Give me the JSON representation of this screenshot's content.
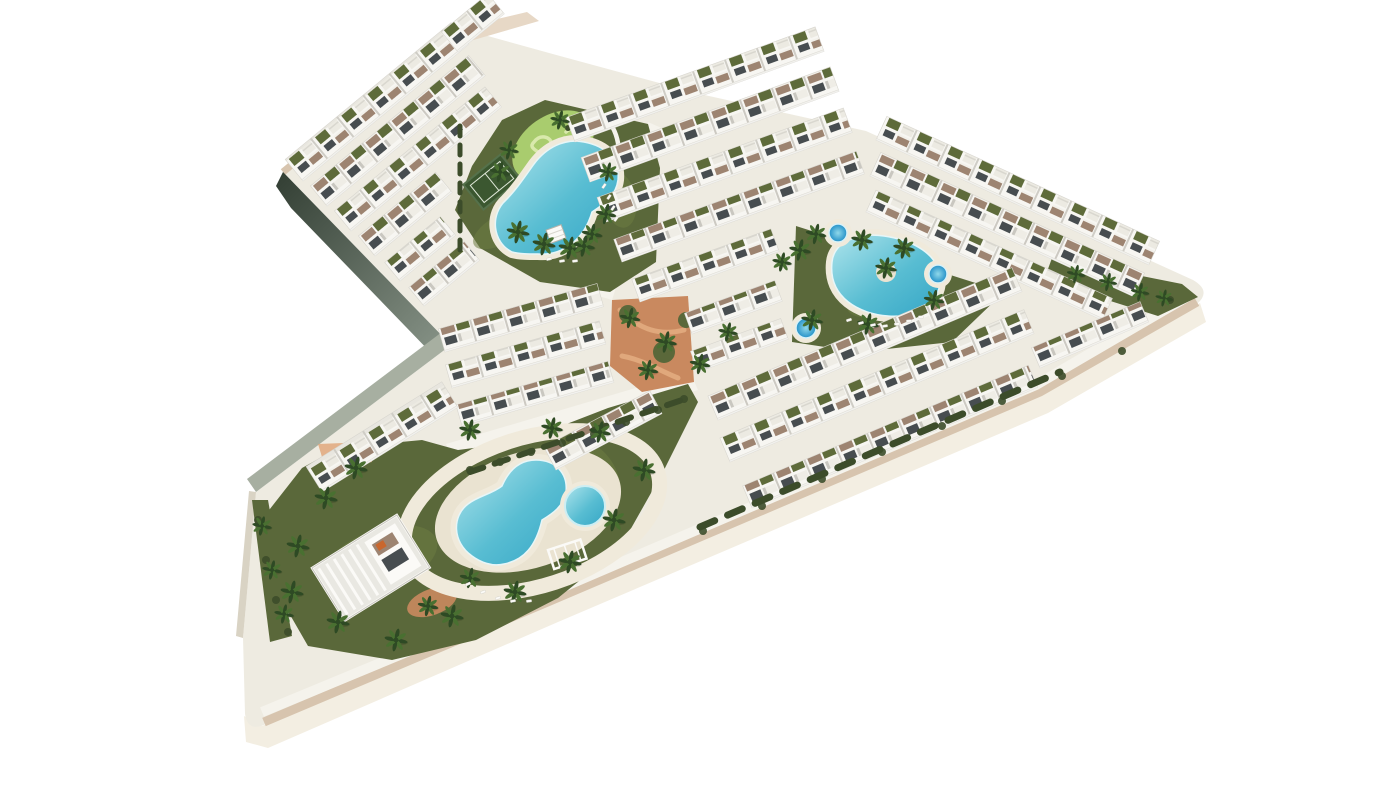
{
  "meta": {
    "title": "Aerial 3D render of a residential resort complex with white apartment blocks, gardens and three swimming pools",
    "canvas_w": 1400,
    "canvas_h": 788
  },
  "palette": {
    "bg": "#ffffff",
    "base": "#eeebe1",
    "road": "#f5f3ec",
    "tan": "#d7c4ae",
    "tanLight": "#e7d8c6",
    "cream": "#f3eee2",
    "deck": "#eae3d1",
    "deckLight": "#f0eadb",
    "darkFaceA": "#323e33",
    "darkFaceB": "#8a968a",
    "grayFace": "#a7afa1",
    "westFace": "#d9d3c4",
    "lawn": "#5a683a",
    "lawnLight": "#6d7c42",
    "hedge": "#3c4c2a",
    "poolLight": "#aee4ec",
    "poolMid": "#58bdd2",
    "poolDeep": "#35a6c6",
    "spaLight": "#8fd8ea",
    "spaDeep": "#2491c8",
    "minigolf": "#a9cc6e",
    "minigolfPath": "#d9e9ac",
    "court": "#3b5730",
    "courtLine": "#dfe8d8",
    "terracotta": "#c9895f",
    "terracottaLight": "#e0a87c",
    "bldg": "#f7f6f2",
    "window": "#474d50",
    "terrace": "#9d8471",
    "roofOlive": "#5e6b3a",
    "palmDark": "#2e4a24",
    "palmMid": "#497031",
    "trunk": "#8d7d5f",
    "white": "#fbfaf7"
  },
  "scene": {
    "outline_path": "M 283,172 L 459,28 L 560,56 L 700,94 L 866,131 L 1193,280 Q 1212,291 1197,304 L 1040,392 L 550,601 L 268,723 Q 248,734 245,714 L 243,638 L 256,492 L 451,345 Z",
    "face_bottom": [
      [
        1200,
        303
      ],
      [
        1040,
        392
      ],
      [
        550,
        601
      ],
      [
        262,
        726
      ],
      [
        244,
        716
      ],
      [
        246,
        742
      ],
      [
        268,
        748
      ],
      [
        558,
        622
      ],
      [
        1048,
        413
      ],
      [
        1206,
        322
      ]
    ],
    "edge_tan_path": "M 1197,302 L 1040,392 L 550,601 L 264,722",
    "edge_walk_path": "M 1192,294 L 1036,385 L 547,594 L 262,712",
    "nw_tan_path": "M 283,172 L 459,28",
    "nw_tan_sliver": [
      [
        459,
        28
      ],
      [
        527,
        12
      ],
      [
        539,
        21
      ],
      [
        470,
        41
      ]
    ],
    "dark_face": [
      [
        283,
        172
      ],
      [
        451,
        345
      ],
      [
        434,
        356
      ],
      [
        291,
        208
      ],
      [
        276,
        186
      ]
    ],
    "gray_face": [
      [
        451,
        345
      ],
      [
        256,
        492
      ],
      [
        247,
        479
      ],
      [
        442,
        332
      ]
    ],
    "west_face": [
      [
        256,
        492
      ],
      [
        243,
        638
      ],
      [
        236,
        636
      ],
      [
        249,
        491
      ]
    ],
    "roads": [
      [
        [
          446,
          444
        ],
        [
          690,
          372
        ],
        [
          698,
          390
        ],
        [
          456,
          464
        ]
      ],
      [
        [
          592,
          294
        ],
        [
          648,
          122
        ],
        [
          666,
          130
        ],
        [
          612,
          300
        ]
      ]
    ],
    "gardens": {
      "main": [
        [
          455,
          210
        ],
        [
          472,
          166
        ],
        [
          502,
          120
        ],
        [
          545,
          100
        ],
        [
          648,
          124
        ],
        [
          660,
          168
        ],
        [
          656,
          262
        ],
        [
          610,
          292
        ],
        [
          540,
          282
        ],
        [
          480,
          248
        ]
      ],
      "oval": [
        [
          796,
          226
        ],
        [
          1004,
          292
        ],
        [
          952,
          342
        ],
        [
          858,
          352
        ],
        [
          792,
          342
        ]
      ],
      "lower": [
        [
          302,
          468
        ],
        [
          338,
          448
        ],
        [
          422,
          440
        ],
        [
          458,
          450
        ],
        [
          520,
          442
        ],
        [
          608,
          408
        ],
        [
          688,
          384
        ],
        [
          698,
          402
        ],
        [
          664,
          470
        ],
        [
          620,
          548
        ],
        [
          558,
          598
        ],
        [
          476,
          640
        ],
        [
          392,
          660
        ],
        [
          308,
          646
        ],
        [
          270,
          580
        ],
        [
          266,
          514
        ]
      ],
      "tip": [
        [
          1052,
          258
        ],
        [
          1182,
          284
        ],
        [
          1198,
          297
        ],
        [
          1158,
          316
        ],
        [
          1044,
          280
        ]
      ],
      "west": [
        [
          252,
          500
        ],
        [
          268,
          500
        ],
        [
          292,
          636
        ],
        [
          270,
          642
        ]
      ]
    },
    "lawn_patches": [
      [
        500,
        230,
        30,
        14,
        -30
      ],
      [
        620,
        200,
        16,
        28,
        -10
      ],
      [
        380,
        560,
        60,
        30,
        -20
      ],
      [
        590,
        480,
        28,
        40,
        -25
      ],
      [
        880,
        300,
        34,
        16,
        -15
      ]
    ],
    "courtyard": [
      [
        612,
        300
      ],
      [
        688,
        296
      ],
      [
        694,
        382
      ],
      [
        642,
        392
      ],
      [
        610,
        366
      ]
    ],
    "courtyard_greens": [
      [
        628,
        314,
        9
      ],
      [
        664,
        352,
        11
      ],
      [
        686,
        320,
        8
      ]
    ],
    "courtyard_paths": [
      "M 620,310 C 640,330 660,336 684,330",
      "M 622,356 C 644,360 662,372 678,378"
    ],
    "terracotta_small": [
      [
        318,
        444
      ],
      [
        368,
        442
      ],
      [
        372,
        462
      ],
      [
        326,
        470
      ]
    ],
    "terracotta_blob": {
      "cx": 432,
      "cy": 602,
      "rx": 26,
      "ry": 13,
      "rot": -20
    },
    "ring": {
      "cx": 532,
      "cy": 512,
      "rx": 132,
      "ry": 74,
      "rot": -18
    },
    "deck_blob": {
      "cx": 528,
      "cy": 510,
      "rx": 96,
      "ry": 58,
      "rot": -18
    },
    "pools": {
      "main": "M 512,252 C 492,242 490,214 506,200 C 516,190 524,178 534,164 C 546,148 564,138 584,142 C 606,146 620,160 618,180 C 616,196 604,204 592,212 C 584,240 562,256 538,254 C 528,254 520,254 512,252 Z",
      "oval": "M 832,262 C 834,242 858,232 884,236 C 912,240 940,254 940,280 C 940,304 916,318 888,316 C 860,314 828,298 832,262 Z",
      "lower": "M 472,556 C 452,542 452,516 468,504 C 478,496 492,494 502,486 C 508,472 518,460 536,460 C 556,460 568,474 566,492 C 564,506 552,514 542,520 C 536,546 524,560 504,564 C 492,567 480,562 472,556 Z",
      "kid": {
        "cx": 585,
        "cy": 506,
        "r": 20
      },
      "island": {
        "cx": 886,
        "cy": 272,
        "r": 10
      }
    },
    "spas": [
      [
        838,
        233,
        9
      ],
      [
        938,
        274,
        9
      ],
      [
        806,
        328,
        10
      ]
    ],
    "minigolf": {
      "cx": 553,
      "cy": 146,
      "rx": 45,
      "ry": 30,
      "rot": -35,
      "paths": [
        "M 534,142 c 6,-8 16,-6 18,2 c 2,8 -8,12 -14,8 c -6,-4 -8,-6 -4,-10",
        "M 556,158 c 8,-4 14,2 10,8 c -4,6 -14,4 -14,-2",
        "M 566,132 c 6,-6 14,-2 12,6 c -2,8 -12,6 -14,0"
      ],
      "wall": "M 596,110 C 620,124 626,158 610,188",
      "bushes": [
        [
          568,
          128,
          3
        ],
        [
          538,
          160,
          2.5
        ],
        [
          580,
          150,
          2.2
        ]
      ]
    },
    "court": {
      "cx": 492,
      "cy": 182,
      "w": 48,
      "h": 32,
      "rot": -39
    },
    "rows": [
      [
        303,
        181,
        215,
        28,
        -39.5,
        "A"
      ],
      [
        327,
        206,
        205,
        26,
        -39.5,
        "B"
      ],
      [
        351,
        231,
        195,
        26,
        -39.5,
        "A"
      ],
      [
        375,
        256,
        100,
        26,
        -39.5,
        "B"
      ],
      [
        400,
        281,
        72,
        24,
        -39.5,
        "A"
      ],
      [
        424,
        306,
        72,
        24,
        -39.5,
        "B"
      ],
      [
        458,
        52,
        60,
        26,
        -39.5,
        "A"
      ],
      [
        575,
        142,
        265,
        26,
        -20,
        "A"
      ],
      [
        590,
        182,
        265,
        26,
        -20,
        "B"
      ],
      [
        606,
        222,
        262,
        26,
        -20,
        "A"
      ],
      [
        622,
        262,
        258,
        24,
        -20,
        "B"
      ],
      [
        640,
        302,
        148,
        24,
        -20,
        "A"
      ],
      [
        692,
        334,
        96,
        22,
        -20,
        "B"
      ],
      [
        698,
        372,
        96,
        22,
        -20,
        "A"
      ],
      [
        876,
        140,
        300,
        26,
        24.6,
        "A"
      ],
      [
        870,
        176,
        290,
        26,
        24.6,
        "B"
      ],
      [
        866,
        212,
        260,
        24,
        24.6,
        "A"
      ],
      [
        445,
        352,
        165,
        24,
        -16,
        "B"
      ],
      [
        452,
        388,
        160,
        24,
        -16,
        "A"
      ],
      [
        462,
        426,
        158,
        22,
        -16,
        "B"
      ],
      [
        718,
        420,
        330,
        26,
        -22.9,
        "B"
      ],
      [
        730,
        462,
        330,
        26,
        -22.9,
        "A"
      ],
      [
        752,
        508,
        310,
        24,
        -22.9,
        "B"
      ],
      [
        1040,
        368,
        118,
        22,
        -23,
        "B"
      ],
      [
        322,
        492,
        160,
        30,
        -32,
        "A"
      ],
      [
        556,
        470,
        120,
        26,
        -28,
        "B"
      ]
    ],
    "villa": {
      "x": 312,
      "y": 568,
      "w": 100,
      "h": 62,
      "rot": -32
    },
    "gazebo": {
      "x": 556,
      "y": 234,
      "rot": -20
    },
    "pergola": {
      "x": 548,
      "y": 550,
      "w": 34,
      "h": 20,
      "rot": -18
    },
    "hedge_lines": [
      {
        "d": "M 700,527 L 1060,372",
        "w": 7,
        "dash": "16 14"
      },
      {
        "d": "M 470,472 L 688,398",
        "w": 6,
        "dash": "14 12"
      },
      {
        "d": "M 460,250 L 460,120",
        "w": 5,
        "dash": "10 9"
      }
    ],
    "palms": [
      [
        518,
        232,
        1
      ],
      [
        544,
        244,
        1
      ],
      [
        570,
        248,
        1
      ],
      [
        592,
        234,
        0.9
      ],
      [
        606,
        214,
        0.9
      ],
      [
        500,
        172,
        0.9
      ],
      [
        509,
        150,
        0.85
      ],
      [
        608,
        172,
        0.85
      ],
      [
        560,
        120,
        0.85
      ],
      [
        584,
        246,
        0.95
      ],
      [
        800,
        250,
        0.95
      ],
      [
        816,
        234,
        0.9
      ],
      [
        862,
        240,
        0.95
      ],
      [
        904,
        248,
        0.95
      ],
      [
        934,
        300,
        0.9
      ],
      [
        868,
        324,
        0.95
      ],
      [
        812,
        320,
        0.95
      ],
      [
        782,
        262,
        0.85
      ],
      [
        886,
        268,
        0.95
      ],
      [
        630,
        318,
        0.9
      ],
      [
        666,
        342,
        0.95
      ],
      [
        700,
        364,
        0.9
      ],
      [
        728,
        332,
        0.85
      ],
      [
        648,
        370,
        0.9
      ],
      [
        356,
        468,
        1
      ],
      [
        326,
        498,
        1
      ],
      [
        298,
        546,
        1
      ],
      [
        292,
        592,
        1
      ],
      [
        338,
        622,
        1
      ],
      [
        396,
        640,
        1
      ],
      [
        452,
        616,
        1
      ],
      [
        515,
        592,
        1
      ],
      [
        570,
        562,
        1
      ],
      [
        614,
        520,
        1
      ],
      [
        644,
        470,
        1
      ],
      [
        600,
        432,
        0.95
      ],
      [
        552,
        428,
        0.95
      ],
      [
        470,
        430,
        0.95
      ],
      [
        428,
        606,
        0.9
      ],
      [
        470,
        578,
        0.9
      ],
      [
        262,
        526,
        0.85
      ],
      [
        272,
        570,
        0.85
      ],
      [
        284,
        614,
        0.85
      ],
      [
        1076,
        274,
        0.8
      ],
      [
        1108,
        282,
        0.8
      ],
      [
        1140,
        292,
        0.8
      ],
      [
        1164,
        298,
        0.75
      ]
    ],
    "bushes": [
      [
        470,
        470
      ],
      [
        500,
        462
      ],
      [
        531,
        452
      ],
      [
        562,
        443
      ],
      [
        594,
        434
      ],
      [
        626,
        422
      ],
      [
        658,
        410
      ],
      [
        684,
        399
      ],
      [
        703,
        531
      ],
      [
        762,
        506
      ],
      [
        822,
        479
      ],
      [
        882,
        452
      ],
      [
        942,
        426
      ],
      [
        1002,
        401
      ],
      [
        1062,
        376
      ],
      [
        1122,
        351
      ],
      [
        258,
        520
      ],
      [
        266,
        560
      ],
      [
        276,
        600
      ],
      [
        288,
        632
      ],
      [
        1170,
        300
      ]
    ],
    "loungers": [
      [
        604,
        186,
        -55
      ],
      [
        609,
        197,
        -55
      ],
      [
        613,
        208,
        -55
      ],
      [
        616,
        219,
        -55
      ],
      [
        549,
        259,
        -12
      ],
      [
        562,
        261,
        -10
      ],
      [
        575,
        261,
        -8
      ],
      [
        849,
        320,
        -18
      ],
      [
        861,
        323,
        -15
      ],
      [
        873,
        325,
        -12
      ],
      [
        885,
        326,
        -9
      ],
      [
        897,
        324,
        -6
      ],
      [
        909,
        321,
        -4
      ],
      [
        921,
        317,
        -2
      ],
      [
        468,
        584,
        -25
      ],
      [
        483,
        592,
        -20
      ],
      [
        498,
        598,
        -16
      ],
      [
        513,
        601,
        -12
      ],
      [
        529,
        601,
        -8
      ]
    ]
  }
}
